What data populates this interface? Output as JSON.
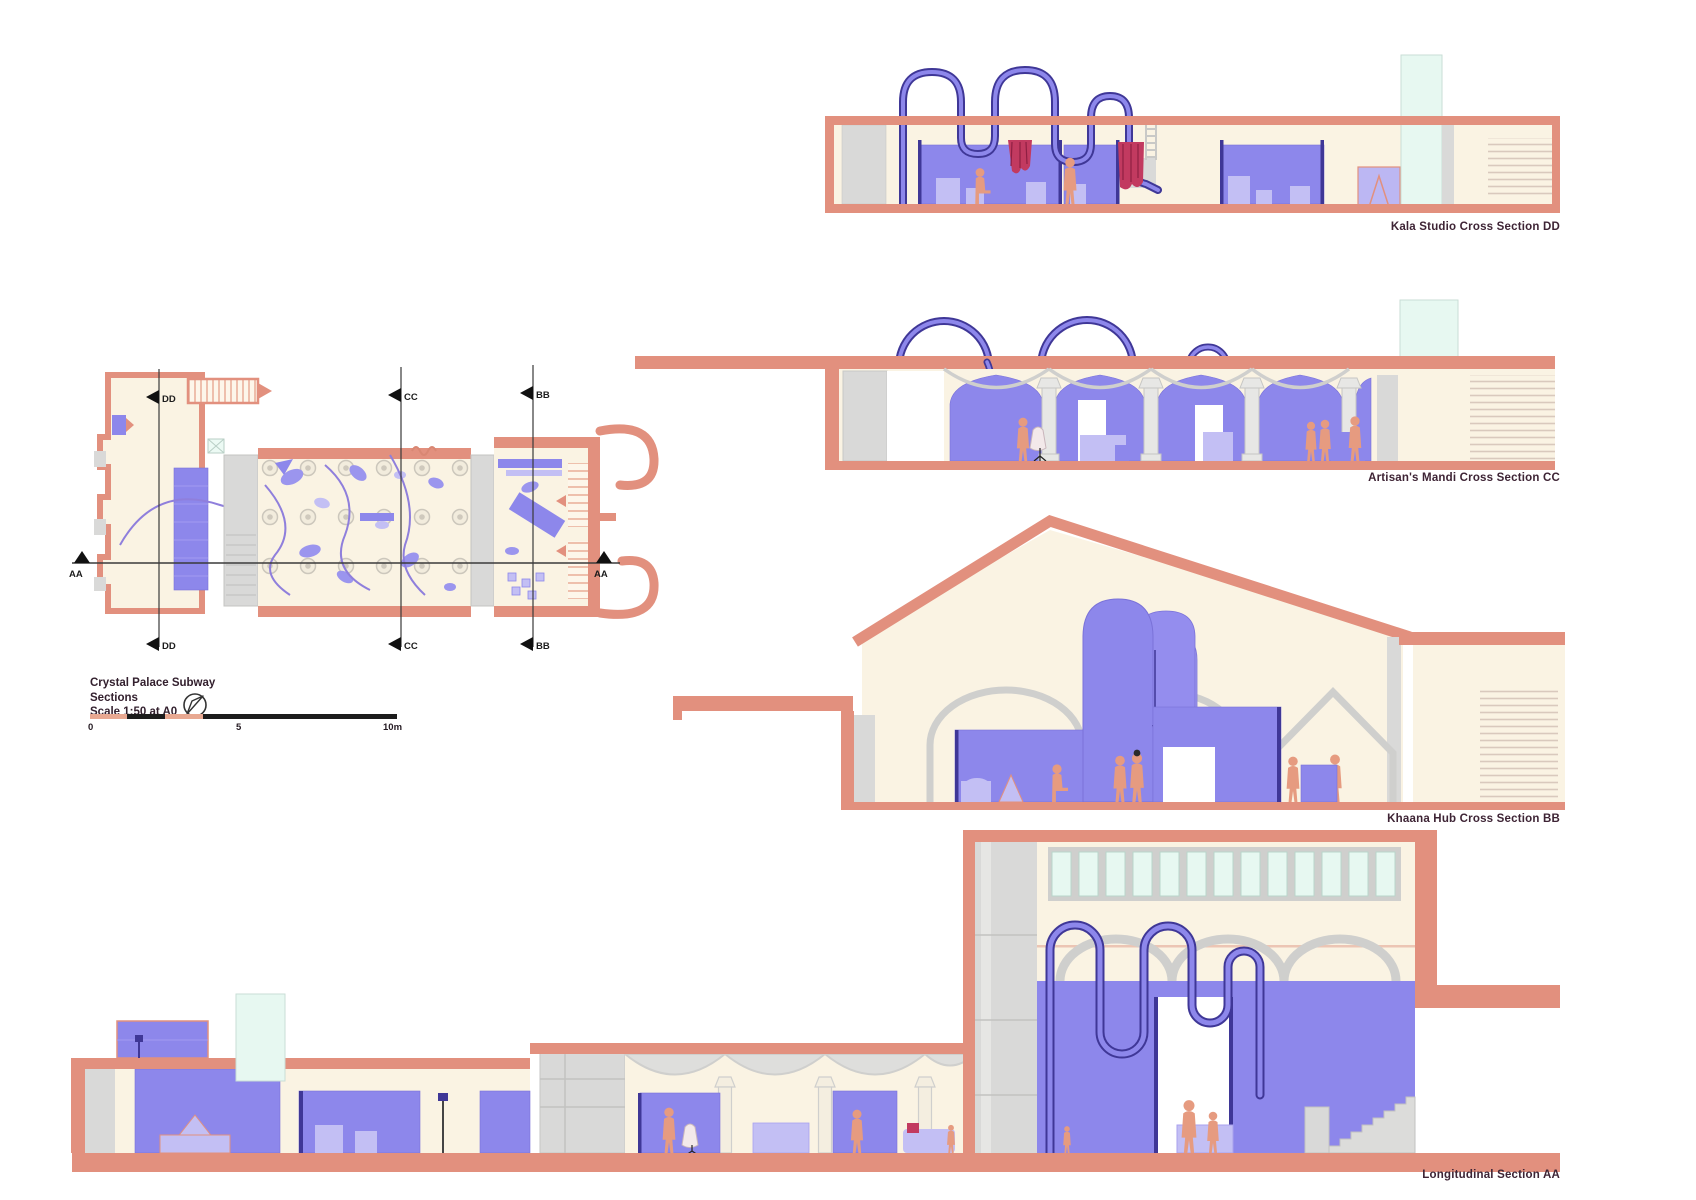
{
  "title_block": {
    "project": "Crystal Palace Subway",
    "subtitle": "Sections",
    "scale_note": "Scale 1:50 at A0"
  },
  "scale_bar": {
    "start": "0",
    "mid": "5",
    "end": "10m"
  },
  "plan": {
    "markers": {
      "dd": "DD",
      "cc": "CC",
      "bb": "BB",
      "aa": "AA"
    }
  },
  "sections": {
    "kala": {
      "label": "Kala Studio Cross Section DD"
    },
    "artisan": {
      "label": "Artisan's Mandi Cross Section CC"
    },
    "khaana": {
      "label": "Khaana Hub Cross Section BB"
    },
    "longitudinal": {
      "label": "Longitudinal Section AA"
    }
  },
  "colors": {
    "salmon_wall": "#E2907E",
    "salmon_hatch": "#E8A891",
    "cream_interior": "#FAF3E3",
    "periwinkle": "#8D87EB",
    "periwinkle_light": "#C3BFF4",
    "navy_tube": "#3F3797",
    "gray_panel": "#D9D9D8",
    "mint_skylight": "#E7F8F1",
    "crimson_textile": "#C23A60",
    "figure_skin": "#E69B80",
    "label_ink": "#3E2435"
  }
}
